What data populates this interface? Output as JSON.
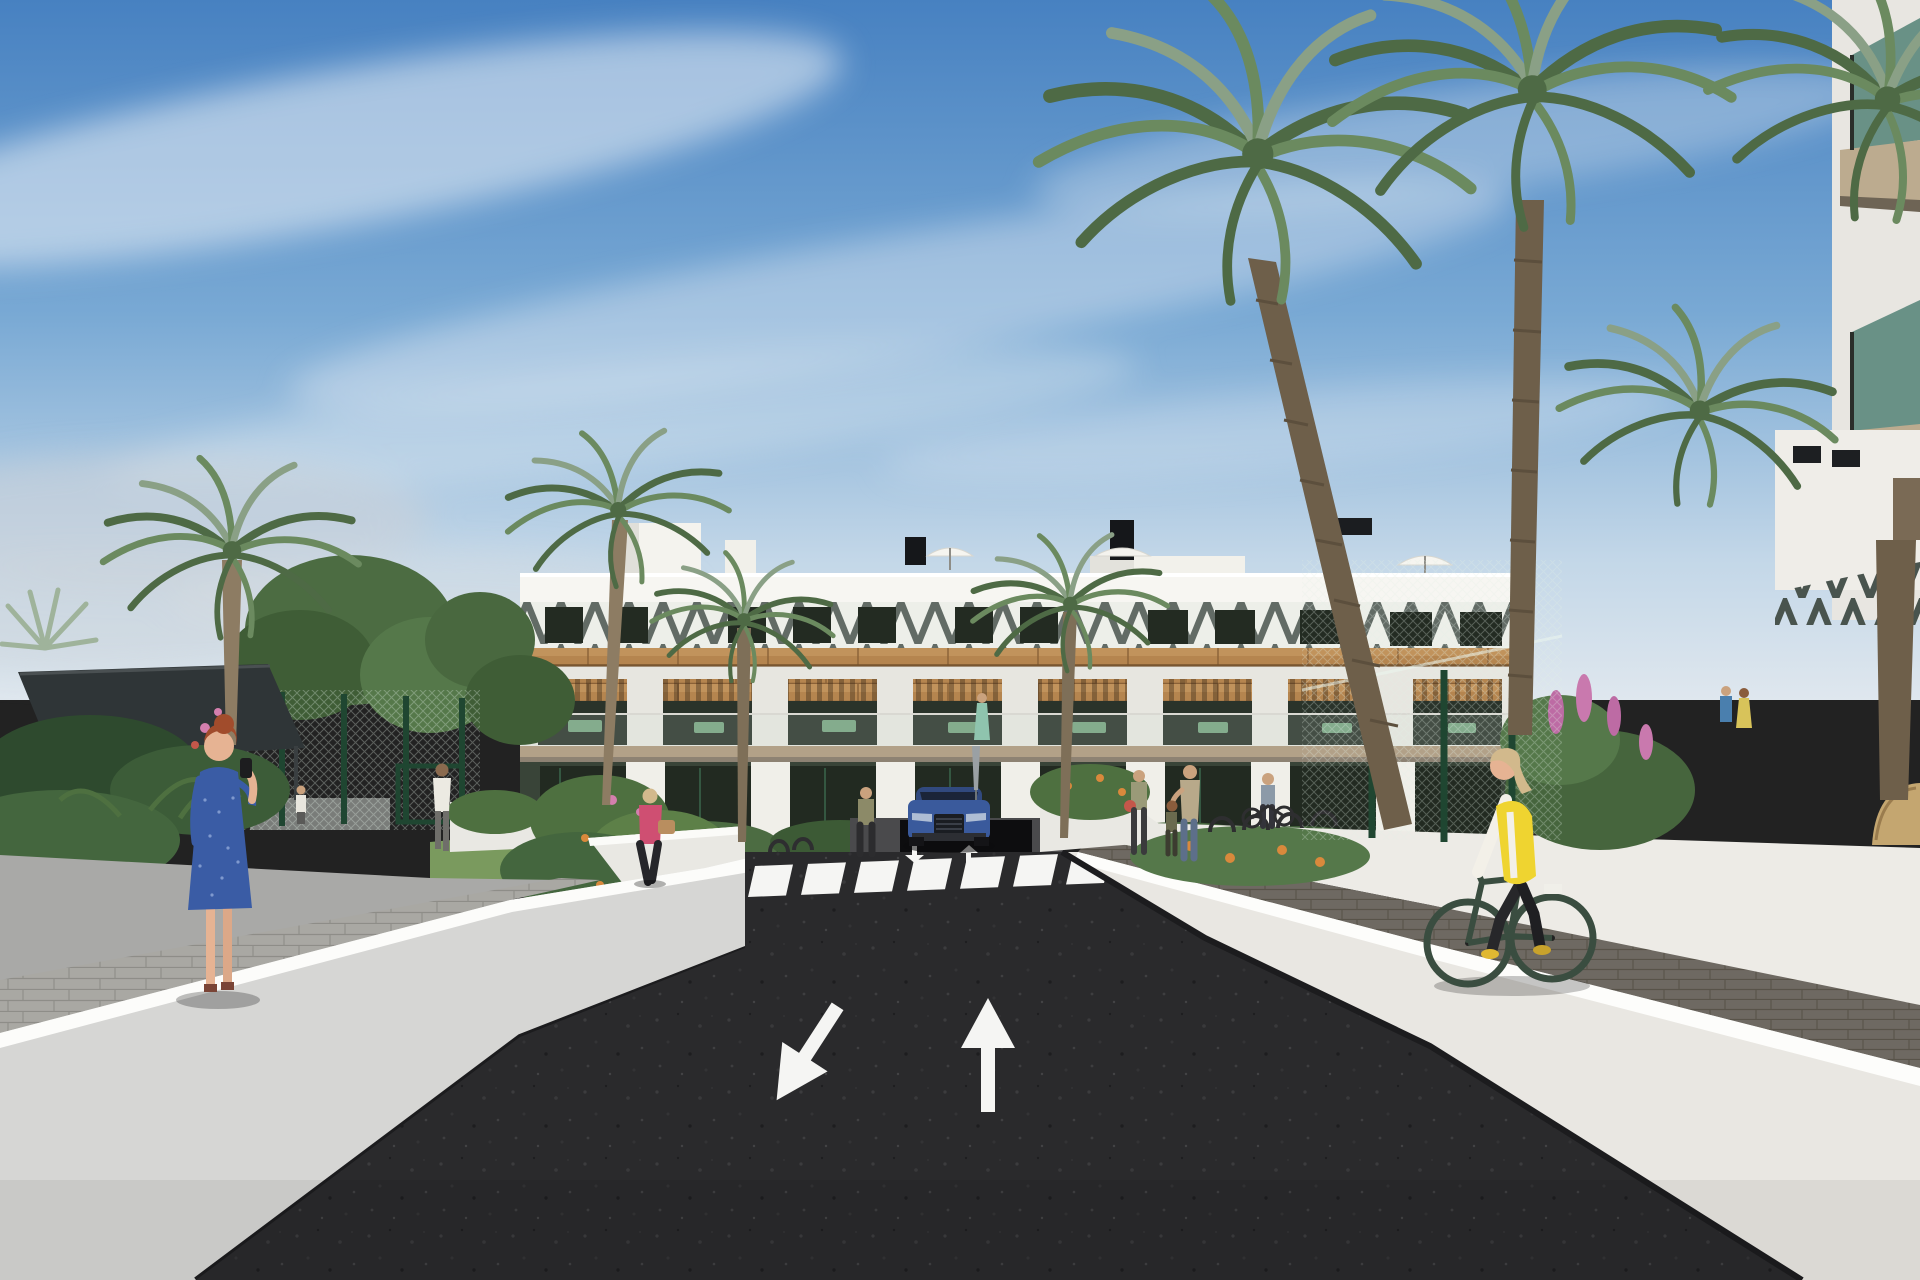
{
  "meta": {
    "title": "Architectural render - residential complex street view",
    "style": "3D photoreal visualization, no visible text or UI"
  },
  "scene": {
    "description": "Two-way private road leading to a white 3-storey apartment building with wood accents and pergola balconies, flanked by white ramp walls, palm trees, tennis-court fencing, pedestrians and a cyclist.",
    "sky": {
      "clouds": "wispy diagonal cirrus streaks",
      "cloud_count": 7
    },
    "building": {
      "floors": 3,
      "balcony_bays": 8,
      "features": [
        "diagonal slat parapet band",
        "wood cladding band",
        "pergola balconies",
        "roof umbrellas",
        "black chimneys",
        "stair towers"
      ]
    },
    "road": {
      "surface": "dark asphalt",
      "markings": {
        "crosswalk_stripes": 7,
        "big_lane_arrows": [
          {
            "direction": "down-left"
          },
          {
            "direction": "up"
          }
        ],
        "small_arrows_near_car": [
          {
            "direction": "down"
          },
          {
            "direction": "up"
          }
        ]
      }
    },
    "vehicles": [
      {
        "type": "suv-front-view",
        "color": "#3a5a9c",
        "location": "parked at building driveway"
      }
    ],
    "people": [
      {
        "id": "phone-woman",
        "desc": "red-haired woman in blue patterned dress on phone, left walkway"
      },
      {
        "id": "white-tee-man",
        "desc": "man in white t-shirt walking up left ramp"
      },
      {
        "id": "pink-jacket-woman",
        "desc": "blonde woman, pink jacket, black pants, tan handbag, beside road"
      },
      {
        "id": "olive-woman",
        "desc": "woman in olive top standing across crosswalk"
      },
      {
        "id": "balcony-woman",
        "desc": "woman in mint dress on first-floor balcony"
      },
      {
        "id": "balcony-couple",
        "desc": "couple on right balcony"
      },
      {
        "id": "red-bag-woman",
        "desc": "woman with red bag near bike racks"
      },
      {
        "id": "mother-child",
        "desc": "mother patting child's head by building"
      },
      {
        "id": "bike-pusher",
        "desc": "person wheeling a bicycle"
      },
      {
        "id": "fence-person",
        "desc": "small figure behind left court fence"
      },
      {
        "id": "cyclist",
        "desc": "blonde woman cycling on right paver path, yellow vest, dark green bike"
      }
    ],
    "vegetation": {
      "palm_crowns": 9,
      "leafy_trees": 3,
      "flower_colors_named": [
        "orange",
        "pink",
        "purple"
      ]
    },
    "colors": {
      "sky_top": "#4781c1",
      "sky_mid": "#79a9d4",
      "sky_low": "#c3d7e8",
      "horizon": "#dfe7ee",
      "cloud": "#eef3f7",
      "cloud_gray": "#c9d1d8",
      "building_white": "#efeee8",
      "building_shade": "#e2e1db",
      "parapet": "#f7f6f2",
      "chevron_dark": "#49544e",
      "chevron_bg": "#edefe9",
      "wood_mid": "#b5854f",
      "wood_light": "#c99e66",
      "wood_dark": "#8a6137",
      "glass_dark": "#232b22",
      "glass_ground": "#222a21",
      "glass_teal": "#5d8a7e",
      "slab_tan": "#b2a188",
      "slab_shadow": "#8d8273",
      "fence_green": "#2d5a40",
      "fence_dark": "#1f4631",
      "canopy": "#2f3537",
      "foliage_dark": "#3f5d36",
      "foliage_mid": "#55784a",
      "foliage_light": "#6f9259",
      "palm_dark": "#4e6a45",
      "palm_mid": "#6b8a5f",
      "palm_light": "#8aa086",
      "trunk": "#8d7c63",
      "trunk_dark": "#6e5f4a",
      "grass": "#7a9a5e",
      "flower_orange": "#d9893c",
      "flower_pink": "#d47fae",
      "flower_purple": "#bd6ba4",
      "asphalt": "#2a2a2c",
      "road_paint": "#f5f5f3",
      "wall_left_face": "#d6d6d4",
      "wall_left_top": "#fcfcfa",
      "wall_gray": "#a9a9a7",
      "wall_sunlit": "#edebe6",
      "walkway_light": "#aeadA9",
      "paver_right": "#6e6962",
      "car_blue": "#3a5a9c",
      "car_roof": "#31497e",
      "vest_yellow": "#efd430",
      "dress_blue": "#3a5ca5",
      "jacket_pink": "#cf4f72",
      "bike_green": "#3a4d40",
      "skin": "#e6b393",
      "hair_red": "#a14c2c",
      "hair_blonde": "#d2b98c"
    }
  }
}
